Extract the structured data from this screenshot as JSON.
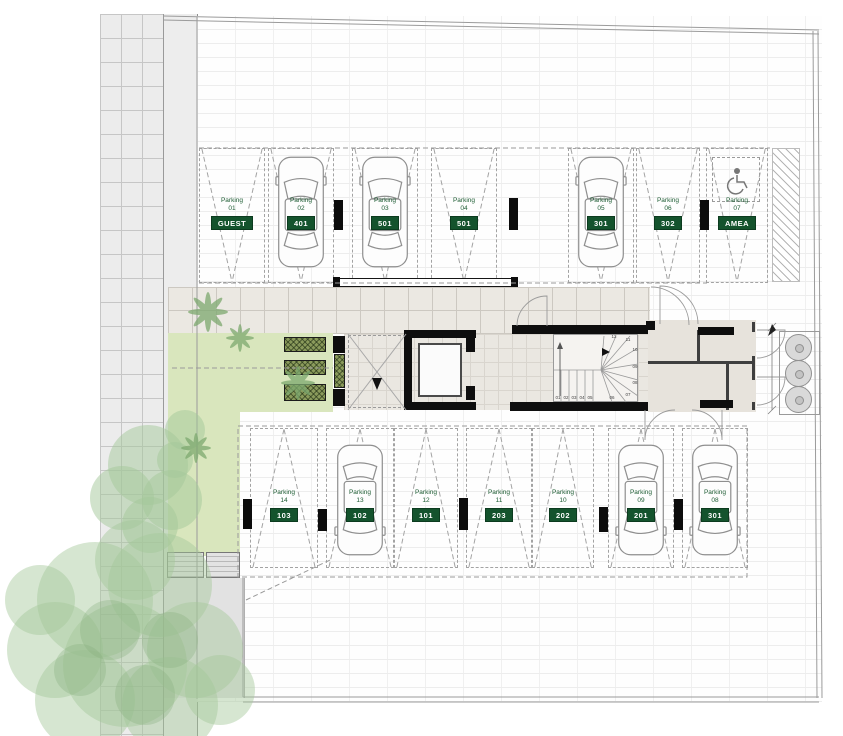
{
  "labels": {
    "parking_word": "Parking"
  },
  "parking": {
    "top_row": [
      {
        "num": "01",
        "plate": "GUEST",
        "car": false,
        "x": 199,
        "w": 66
      },
      {
        "num": "02",
        "plate": "401",
        "car": true,
        "x": 268,
        "w": 66
      },
      {
        "num": "03",
        "plate": "501",
        "car": true,
        "x": 352,
        "w": 66
      },
      {
        "num": "04",
        "plate": "501",
        "car": false,
        "x": 431,
        "w": 66
      },
      {
        "num": "05",
        "plate": "301",
        "car": true,
        "x": 568,
        "w": 66
      },
      {
        "num": "06",
        "plate": "302",
        "car": false,
        "x": 636,
        "w": 64
      },
      {
        "num": "07",
        "plate": "AMEA",
        "car": false,
        "x": 706,
        "w": 62,
        "icon": "wheelchair"
      }
    ],
    "bottom_row": [
      {
        "num": "14",
        "plate": "103",
        "car": false,
        "x": 250,
        "w": 68
      },
      {
        "num": "13",
        "plate": "102",
        "car": true,
        "x": 326,
        "w": 68
      },
      {
        "num": "12",
        "plate": "101",
        "car": false,
        "x": 394,
        "w": 64
      },
      {
        "num": "11",
        "plate": "203",
        "car": false,
        "x": 466,
        "w": 66
      },
      {
        "num": "10",
        "plate": "202",
        "car": false,
        "x": 532,
        "w": 62
      },
      {
        "num": "09",
        "plate": "201",
        "car": true,
        "x": 608,
        "w": 66
      },
      {
        "num": "08",
        "plate": "301",
        "car": true,
        "x": 682,
        "w": 66
      }
    ]
  },
  "stairs": {
    "steps": [
      "01",
      "02",
      "03",
      "04",
      "05",
      "06",
      "07",
      "08",
      "09",
      "10",
      "11",
      "12"
    ]
  },
  "colors": {
    "plate_green": "#14532d",
    "label_green": "#1d5c33",
    "courtyard_green": "#d9e6bd",
    "planter_green": "#8a9a5b"
  }
}
